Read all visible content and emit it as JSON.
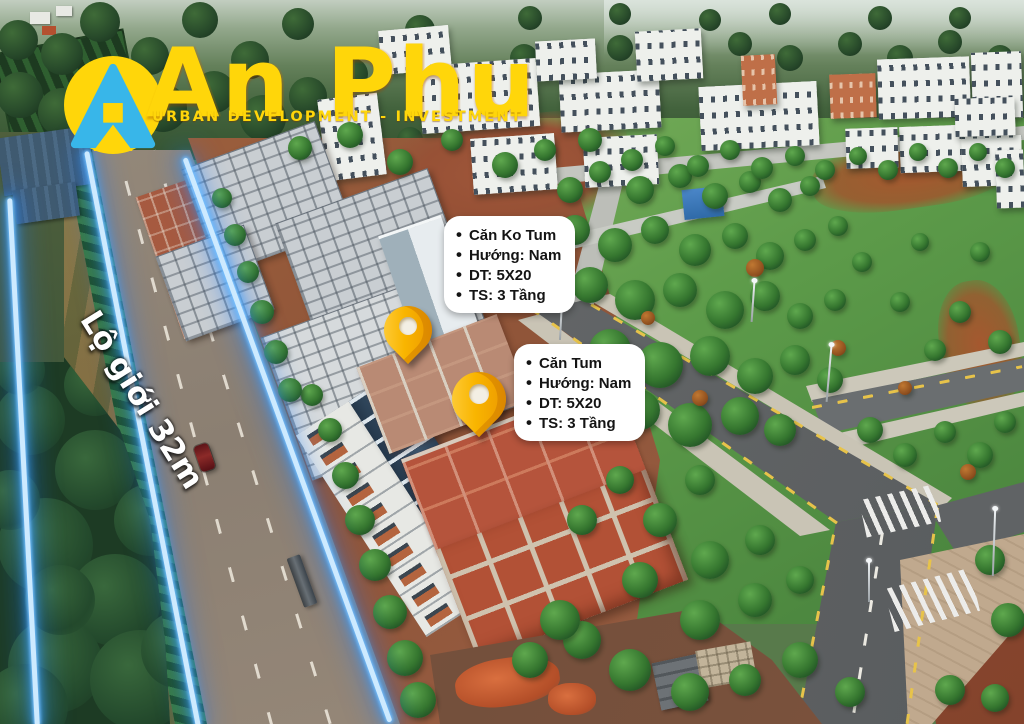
{
  "brand": {
    "name": "An Phu",
    "tagline": "URBAN DEVELOPMENT - INVESTMENT",
    "logo_letter": "A",
    "colors": {
      "yellow": "#ffd60a",
      "blue": "#38b6e9"
    }
  },
  "overlay": {
    "road_label": "Lộ giới 32m",
    "neon_color": "#2da8ff",
    "pin_color": "#f9b500",
    "callouts": [
      {
        "id": "can-ko-tum",
        "lines": [
          "Căn Ko Tum",
          "Hướng: Nam",
          "DT: 5X20",
          "TS: 3 Tầng"
        ]
      },
      {
        "id": "can-tum",
        "lines": [
          "Căn Tum",
          "Hướng: Nam",
          "DT: 5X20",
          "TS: 3 Tầng"
        ]
      }
    ],
    "pins": [
      {
        "name": "pin-can-ko-tum"
      },
      {
        "name": "pin-can-tum"
      }
    ]
  }
}
